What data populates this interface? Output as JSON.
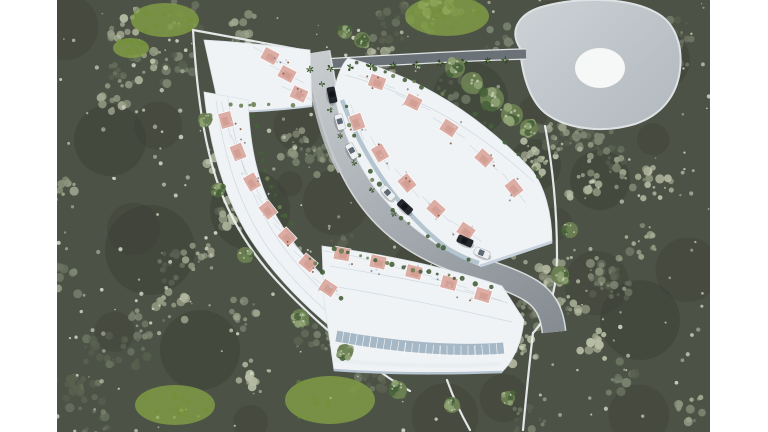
{
  "scene": {
    "type": "aerial-3d-architectural-render",
    "subject": "Bird's-eye rendering of a curved hillside residential development of white terraced townhouses set in dense woodland",
    "notable_features": [
      "teardrop-shaped concrete deck with circular helipad at the upper right",
      "palm-lined access road along the top boundary",
      "S-curved internal road with cars",
      "white perimeter wall around the wedge-shaped plot",
      "salmon-pink rooftop terrace decks with planters and outdoor furniture"
    ]
  },
  "palette": {
    "page_margin": "#ffffff",
    "forest_base": "#4d5246",
    "forest_dark": "#383d33",
    "forest_canopy": [
      "#59604f",
      "#6a7260",
      "#7c8471",
      "#8f967f",
      "#a2a890",
      "#b7bca4"
    ],
    "forest_speckle": "#d2d6c2",
    "lawn_green": "#8aab45",
    "building_white": "#eff3f6",
    "building_shade": "#c7d2de",
    "glass_blue": "#9db0c0",
    "terrace_pink": "#dcaaa0",
    "terrace_pink_deep": "#c98f84",
    "greenery_dark": "#46603a",
    "greenery_mid": "#6b8052",
    "greenery_light": "#90a477",
    "road_light": "#c9cdd0",
    "road_mid": "#a8aeb3",
    "road_dark": "#858c92",
    "access_road": "#6a7177",
    "wall_white": "#eceff0",
    "deck_gray": "#b3bac0",
    "deck_rim": "#dee2e4",
    "helipad_white": "#f6f8f8",
    "car_dark": "#23272d",
    "car_white": "#edf0f2",
    "car_glass": "#4d5a66"
  },
  "helipad": {
    "cx": 600,
    "cy": 68,
    "rx": 25,
    "ry": 20
  },
  "access_road": {
    "palm_xs": [
      310,
      330,
      350,
      371,
      393,
      416,
      440,
      464,
      488,
      505
    ],
    "y_left": 66,
    "y_right": 55
  },
  "lawn_patches": [
    {
      "cx": 447,
      "cy": 16,
      "rx": 42,
      "ry": 20
    },
    {
      "cx": 165,
      "cy": 20,
      "rx": 34,
      "ry": 17
    },
    {
      "cx": 131,
      "cy": 48,
      "rx": 18,
      "ry": 10
    },
    {
      "cx": 330,
      "cy": 400,
      "rx": 45,
      "ry": 24
    },
    {
      "cx": 175,
      "cy": 405,
      "rx": 40,
      "ry": 20
    }
  ],
  "garden_trees": [
    {
      "cx": 455,
      "cy": 68,
      "r": 10
    },
    {
      "cx": 472,
      "cy": 83,
      "r": 11
    },
    {
      "cx": 492,
      "cy": 99,
      "r": 12
    },
    {
      "cx": 512,
      "cy": 115,
      "r": 11
    },
    {
      "cx": 529,
      "cy": 128,
      "r": 9
    },
    {
      "cx": 362,
      "cy": 40,
      "r": 8
    },
    {
      "cx": 345,
      "cy": 32,
      "r": 7
    },
    {
      "cx": 300,
      "cy": 318,
      "r": 9
    },
    {
      "cx": 345,
      "cy": 352,
      "r": 8
    },
    {
      "cx": 398,
      "cy": 390,
      "r": 9
    },
    {
      "cx": 452,
      "cy": 405,
      "r": 8
    },
    {
      "cx": 508,
      "cy": 398,
      "r": 7
    },
    {
      "cx": 245,
      "cy": 255,
      "r": 8
    },
    {
      "cx": 218,
      "cy": 190,
      "r": 7
    },
    {
      "cx": 205,
      "cy": 120,
      "r": 7
    },
    {
      "cx": 560,
      "cy": 275,
      "r": 9
    },
    {
      "cx": 570,
      "cy": 230,
      "r": 8
    }
  ],
  "cars": [
    {
      "color": "dark",
      "x": 332,
      "y": 95,
      "deg": 78
    },
    {
      "color": "white",
      "x": 340,
      "y": 122,
      "deg": 74
    },
    {
      "color": "white",
      "x": 352,
      "y": 151,
      "deg": 62
    },
    {
      "color": "white",
      "x": 388,
      "y": 193,
      "deg": 47
    },
    {
      "color": "dark",
      "x": 405,
      "y": 207,
      "deg": 43
    },
    {
      "color": "dark",
      "x": 465,
      "y": 241,
      "deg": 24
    },
    {
      "color": "white",
      "x": 482,
      "y": 253,
      "deg": 22
    }
  ],
  "building_rows": [
    {
      "name": "north-terrace-row",
      "units": 3,
      "terraces": [
        [
          270,
          56,
          28
        ],
        [
          287,
          74,
          28
        ],
        [
          299,
          94,
          24
        ]
      ]
    },
    {
      "name": "west-terrace-row",
      "units": 7,
      "terraces": [
        [
          226,
          120,
          75
        ],
        [
          238,
          152,
          68
        ],
        [
          252,
          182,
          60
        ],
        [
          268,
          210,
          52
        ],
        [
          287,
          237,
          46
        ],
        [
          308,
          263,
          40
        ],
        [
          328,
          288,
          34
        ]
      ]
    },
    {
      "name": "central-terrace-row",
      "units": 10,
      "terraces": [
        [
          377,
          82,
          20
        ],
        [
          413,
          102,
          26
        ],
        [
          449,
          128,
          33
        ],
        [
          484,
          158,
          42
        ],
        [
          514,
          188,
          52
        ],
        [
          357,
          122,
          70
        ],
        [
          380,
          153,
          60
        ],
        [
          407,
          183,
          50
        ],
        [
          436,
          209,
          42
        ],
        [
          466,
          231,
          34
        ]
      ]
    },
    {
      "name": "south-terrace-row",
      "units": 5,
      "terraces": [
        [
          342,
          254,
          10
        ],
        [
          378,
          262,
          12
        ],
        [
          414,
          272,
          14
        ],
        [
          449,
          283,
          15
        ],
        [
          483,
          295,
          17
        ]
      ]
    }
  ]
}
